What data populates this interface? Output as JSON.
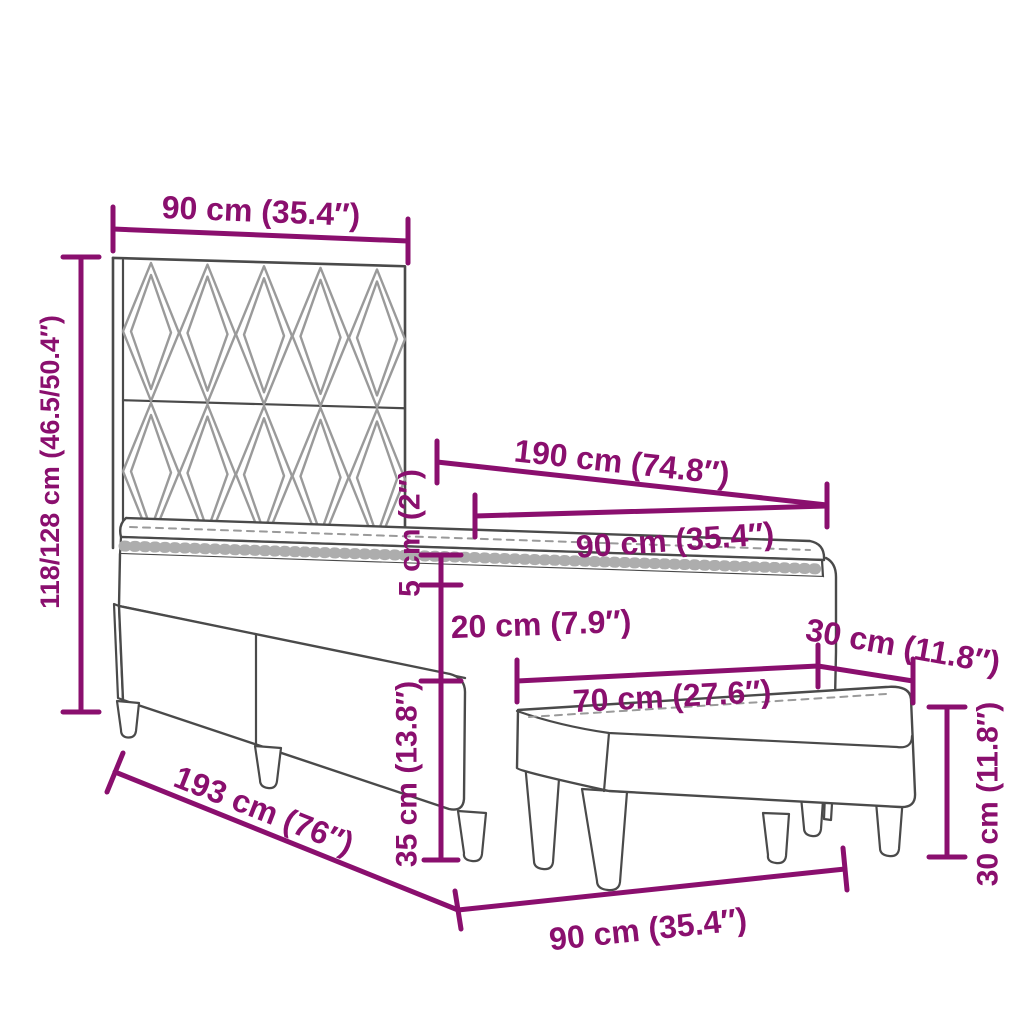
{
  "diagram": {
    "title_hint": "bed-with-bench-dimension-diagram",
    "colors": {
      "dimension": "#8A0F6E",
      "outline": "#4A4A4A",
      "pattern": "#9A9A9A",
      "background": "#FFFFFF"
    },
    "dims": {
      "headboard_width": "90 cm (35.4″)",
      "bed_height": "118/128 cm (46.5/50.4″)",
      "mattress_length": "190 cm (74.8″)",
      "mattress_width": "90 cm (35.4″)",
      "topper_thickness": "5 cm (2″)",
      "mattress_thickness": "20 cm (7.9″)",
      "bench_depth": "30 cm (11.8″)",
      "bench_width": "70 cm (27.6″)",
      "base_height": "35 cm (13.8″)",
      "bed_length": "193 cm (76″)",
      "bed_floor_width": "90 cm (35.4″)",
      "bench_height": "30 cm (11.8″)"
    }
  }
}
